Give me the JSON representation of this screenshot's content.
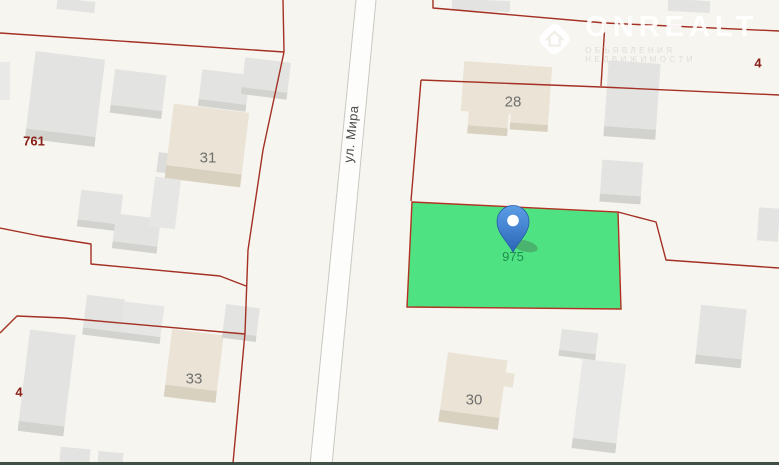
{
  "street": {
    "name": "ул. Мира"
  },
  "pin": {
    "parcel_number": "975"
  },
  "house_numbers": {
    "h31": "31",
    "h28": "28",
    "h30": "30",
    "h33": "33"
  },
  "parcel_numbers": {
    "p761": "761",
    "p4_left": "4",
    "p4_right": "4"
  },
  "watermark": {
    "brand": "ONREALT",
    "tagline": "ОБЪЯВЛЕНИЯ НЕДВИЖИМОСТИ"
  },
  "colors": {
    "background": "#f7f5f0",
    "selected_parcel_fill": "#40e07a",
    "parcel_boundary_red": "#a33023",
    "building_gray": "#e3e3e1",
    "building_beige": "#eae3d6",
    "street_fill": "#fdfdfc",
    "pin_blue": "#3578cd",
    "house_label_gray": "#6f6f6d",
    "parcel_label_red": "#8a2018",
    "pin_label_green": "#1f8e4e"
  }
}
